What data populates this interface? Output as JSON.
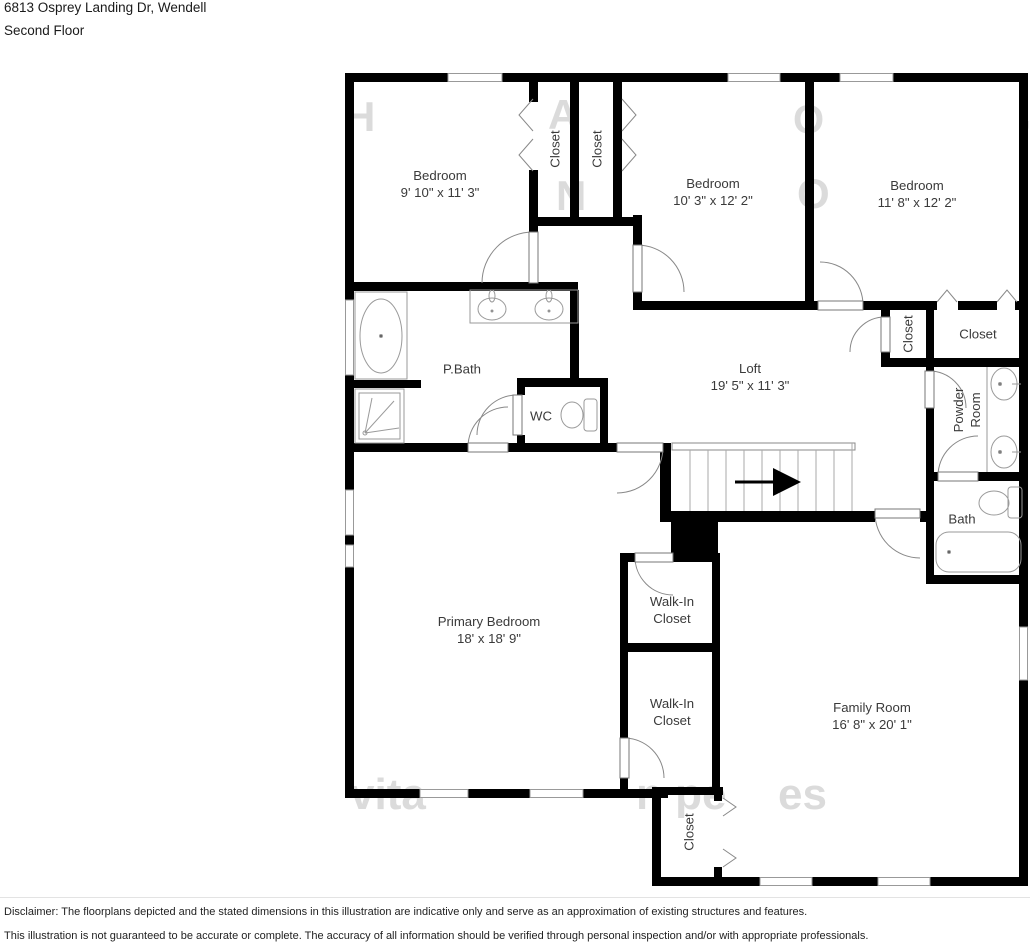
{
  "header": {
    "address": "6813 Osprey Landing Dr, Wendell",
    "floor": "Second Floor"
  },
  "rooms": [
    {
      "id": "bedroom-1",
      "label": "Bedroom",
      "dims": "9' 10\" x 11' 3\"",
      "x": 440,
      "y": 184,
      "rotated": false
    },
    {
      "id": "closet-bedroom-1",
      "label": "Closet",
      "x": 555,
      "y": 149,
      "rotated": true
    },
    {
      "id": "closet-bedroom-2",
      "label": "Closet",
      "x": 597,
      "y": 149,
      "rotated": true
    },
    {
      "id": "bedroom-2",
      "label": "Bedroom",
      "dims": "10' 3\" x 12' 2\"",
      "x": 713,
      "y": 192,
      "rotated": false
    },
    {
      "id": "bedroom-3",
      "label": "Bedroom",
      "dims": "11' 8\" x 12' 2\"",
      "x": 917,
      "y": 194,
      "rotated": false
    },
    {
      "id": "primary-bath",
      "label": "P.Bath",
      "x": 462,
      "y": 369,
      "rotated": false
    },
    {
      "id": "wc",
      "label": "WC",
      "x": 541,
      "y": 416,
      "rotated": false
    },
    {
      "id": "loft",
      "label": "Loft",
      "dims": "19' 5\" x 11' 3\"",
      "x": 750,
      "y": 377,
      "rotated": false
    },
    {
      "id": "hall-closet",
      "label": "Closet",
      "x": 908,
      "y": 334,
      "rotated": true
    },
    {
      "id": "closet-bedroom-3",
      "label": "Closet",
      "x": 978,
      "y": 334,
      "rotated": false
    },
    {
      "id": "powder-room",
      "label": "Powder",
      "label2": "Room",
      "x": 967,
      "y": 410,
      "rotated": true
    },
    {
      "id": "bath",
      "label": "Bath",
      "x": 962,
      "y": 519,
      "rotated": false
    },
    {
      "id": "primary-bedroom",
      "label": "Primary Bedroom",
      "dims": "18' x 18' 9\"",
      "x": 489,
      "y": 630,
      "rotated": false
    },
    {
      "id": "walk-in-closet-1",
      "label": "Walk-In",
      "label2": "Closet",
      "x": 672,
      "y": 610,
      "rotated": false
    },
    {
      "id": "walk-in-closet-2",
      "label": "Walk-In",
      "label2": "Closet",
      "x": 672,
      "y": 712,
      "rotated": false
    },
    {
      "id": "family-room",
      "label": "Family Room",
      "dims": "16' 8\" x 20' 1\"",
      "x": 872,
      "y": 716,
      "rotated": false
    },
    {
      "id": "closet-family",
      "label": "Closet",
      "x": 689,
      "y": 832,
      "rotated": true
    }
  ],
  "watermark": {
    "fragments": [
      {
        "text": "H",
        "x": 345,
        "y": 93,
        "size": 42
      },
      {
        "text": "A",
        "x": 548,
        "y": 91,
        "size": 42
      },
      {
        "text": "O",
        "x": 793,
        "y": 98,
        "size": 40
      },
      {
        "text": ",",
        "x": 1020,
        "y": 92,
        "size": 40
      },
      {
        "text": "N",
        "x": 556,
        "y": 172,
        "size": 42
      },
      {
        "text": "O",
        "x": 797,
        "y": 170,
        "size": 42
      },
      {
        "text": "vita",
        "x": 350,
        "y": 770,
        "size": 44
      },
      {
        "text": "n pe",
        "x": 636,
        "y": 770,
        "size": 44
      },
      {
        "text": "es",
        "x": 778,
        "y": 770,
        "size": 44
      }
    ]
  },
  "footer": {
    "line1": "Disclaimer: The floorplans depicted and the stated dimensions in this illustration are indicative only and serve as an approximation of existing structures and features.",
    "line2": "This illustration is not guaranteed to be accurate or complete. The accuracy of all information should be verified through personal inspection and/or with appropriate professionals."
  },
  "colors": {
    "wall": "#000000",
    "fixture_outline": "#9a9a9a",
    "door_arc": "#888888",
    "label_text": "#3a3a3a",
    "watermark": "#8a8a8a"
  }
}
